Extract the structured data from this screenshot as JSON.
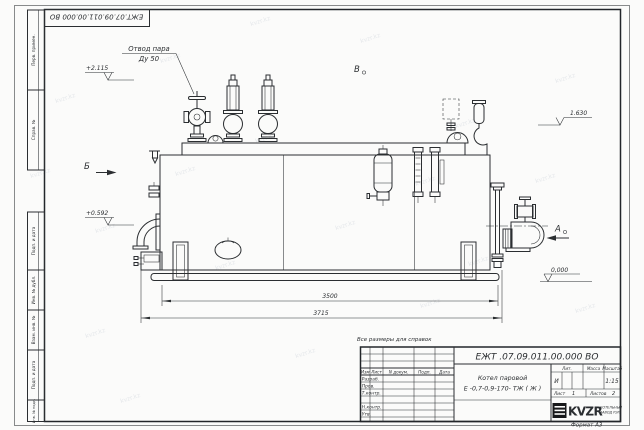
{
  "frame": {
    "doc_number_top": "ЕЖТ.07.09.011.00.000  ВО",
    "format_label": "Формат А3",
    "left_labels": [
      "Перв. примен.",
      "Справ. №",
      "Подп. и дата",
      "Инв. № дубл.",
      "Взам. инв. №",
      "Подп. и дата",
      "Инв. № подл."
    ]
  },
  "annotations": {
    "steam_outlet_1": "Отвод пара",
    "steam_outlet_2": "Ду 50",
    "elev_top_left": "+2.115",
    "elev_mid_left": "+0.592",
    "elev_top_right": "1.630",
    "elev_ground": "0,000",
    "view_a": "А",
    "view_b": "Б",
    "view_v": "В",
    "note": "Все размеры для справок"
  },
  "dimensions": {
    "inner": "3500",
    "overall": "3715"
  },
  "title_block": {
    "doc_number": "ЕЖТ .07.09.011.00.000  ВО",
    "name_line1": "Котел паровой",
    "name_line2": "Е -0,7-0,9-170- ТЖ ( Ж )",
    "header": {
      "izm": "Изм",
      "list": "Лист",
      "doc": "N докум.",
      "podp": "Подп.",
      "data": "Дата"
    },
    "roles": [
      "Разраб.",
      "Пров.",
      "Т.контр.",
      "Н.контр.",
      "Утв."
    ],
    "lit_label": "Лит.",
    "mass_label": "Масса",
    "scale_label": "Масштаб",
    "lit_value": "И",
    "scale_value": "1:15",
    "sheet_label": "Лист",
    "sheet_number": "1",
    "sheets_label": "Листов",
    "sheets_total": "2",
    "logo_text": "KVZR",
    "logo_sub1": "КОТЕЛЬНЫЙ",
    "logo_sub2": "ЗАВОД РЭП"
  },
  "watermark": {
    "text": "kvzr.kz"
  }
}
